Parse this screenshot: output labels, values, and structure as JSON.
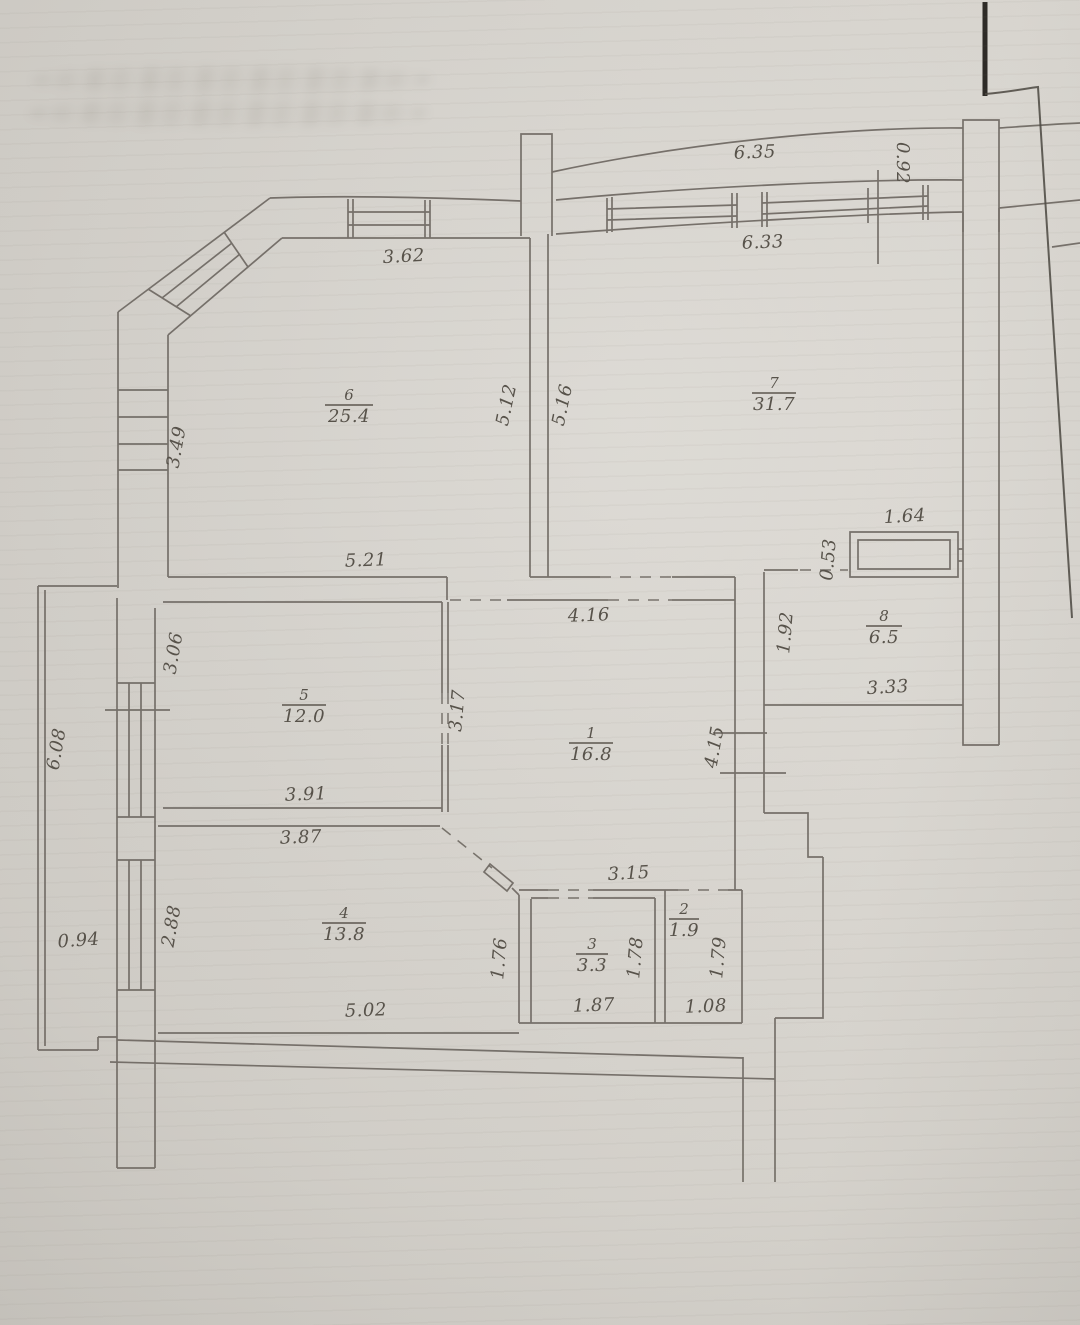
{
  "page": {
    "background": "#d7d4ce",
    "line_color": "#6e6862",
    "text_color": "#57524a",
    "edge_color": "#2e2b27",
    "kind": "scanned apartment floor plan"
  },
  "rooms": [
    {
      "number": "6",
      "area": "25.4"
    },
    {
      "number": "7",
      "area": "31.7"
    },
    {
      "number": "8",
      "area": "6.5"
    },
    {
      "number": "5",
      "area": "12.0"
    },
    {
      "number": "1",
      "area": "16.8"
    },
    {
      "number": "4",
      "area": "13.8"
    },
    {
      "number": "3",
      "area": "3.3"
    },
    {
      "number": "2",
      "area": "1.9"
    }
  ],
  "dimensions": [
    {
      "label": "6.35"
    },
    {
      "label": "0.92"
    },
    {
      "label": "6.33"
    },
    {
      "label": "3.62"
    },
    {
      "label": "3.49"
    },
    {
      "label": "5.12"
    },
    {
      "label": "5.16"
    },
    {
      "label": "5.21"
    },
    {
      "label": "1.64"
    },
    {
      "label": "0.53"
    },
    {
      "label": "1.92"
    },
    {
      "label": "3.33"
    },
    {
      "label": "4.16"
    },
    {
      "label": "3.06"
    },
    {
      "label": "3.17"
    },
    {
      "label": "4.15"
    },
    {
      "label": "3.91"
    },
    {
      "label": "3.87"
    },
    {
      "label": "6.08"
    },
    {
      "label": "2.88"
    },
    {
      "label": "0.94"
    },
    {
      "label": "1.76"
    },
    {
      "label": "3.15"
    },
    {
      "label": "1.78"
    },
    {
      "label": "1.79"
    },
    {
      "label": "1.87"
    },
    {
      "label": "1.08"
    },
    {
      "label": "5.02"
    }
  ]
}
